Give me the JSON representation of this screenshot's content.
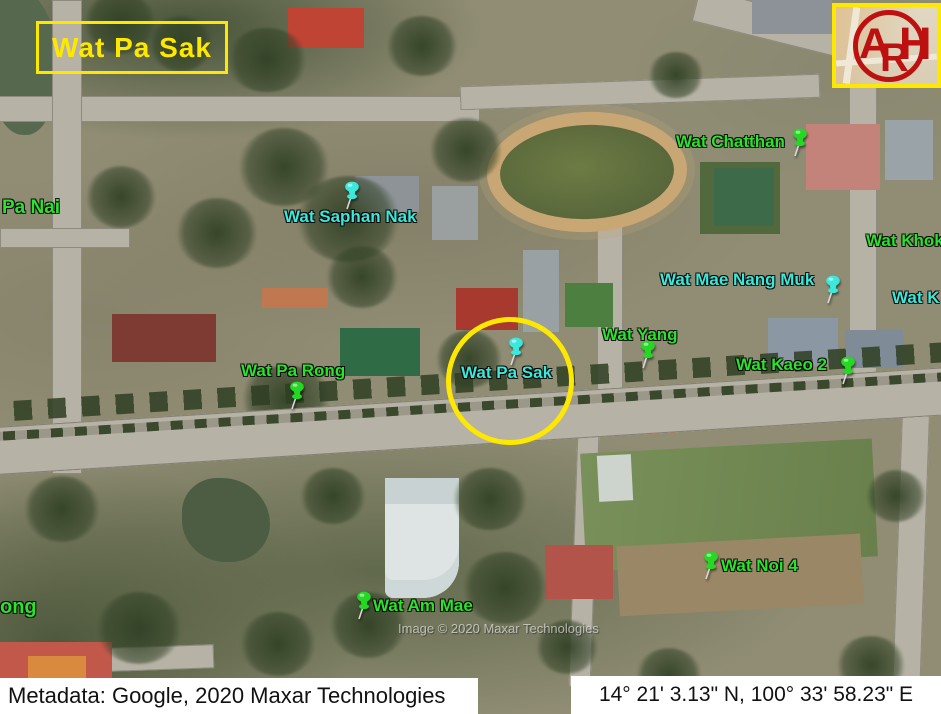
{
  "title_box": {
    "label": "Wat Pa Sak"
  },
  "logo": {
    "letters": [
      "A",
      "R",
      "H"
    ]
  },
  "map": {
    "markers": [
      {
        "id": "pa-nai",
        "label": "Pa Nai",
        "color": "green",
        "pin": false
      },
      {
        "id": "wat-saphan-nak",
        "label": "Wat Saphan Nak",
        "color": "cyan",
        "pin": true
      },
      {
        "id": "wat-chatthan",
        "label": "Wat Chatthan",
        "color": "green",
        "pin": true
      },
      {
        "id": "wat-khok",
        "label": "Wat Khok",
        "color": "green",
        "pin": false
      },
      {
        "id": "wat-mae-nang-muk",
        "label": "Wat Mae Nang Muk",
        "color": "cyan",
        "pin": true
      },
      {
        "id": "wat-k",
        "label": "Wat K",
        "color": "cyan",
        "pin": false
      },
      {
        "id": "wat-yang",
        "label": "Wat Yang",
        "color": "green",
        "pin": true
      },
      {
        "id": "wat-kaeo-2",
        "label": "Wat Kaeo 2",
        "color": "green",
        "pin": true
      },
      {
        "id": "wat-pa-rong",
        "label": "Wat Pa Rong",
        "color": "green",
        "pin": true
      },
      {
        "id": "wat-pa-sak",
        "label": "Wat Pa Sak",
        "color": "cyan",
        "pin": true,
        "highlighted": true
      },
      {
        "id": "wat-noi-4",
        "label": "Wat Noi 4",
        "color": "green",
        "pin": true
      },
      {
        "id": "wat-am-mae",
        "label": "Wat Am Mae",
        "color": "green",
        "pin": true
      },
      {
        "id": "ong",
        "label": "ong",
        "color": "green",
        "pin": false
      }
    ],
    "watermark": "Image © 2020 Maxar Technologies"
  },
  "footer": {
    "metadata": "Metadata: Google, 2020 Maxar Technologies",
    "coordinates": "14° 21' 3.13\" N, 100° 33' 58.23\" E"
  },
  "colors": {
    "label_green": "#2BE32B",
    "label_cyan": "#3CE8DC",
    "highlight_yellow": "#FFE800",
    "logo_red": "#BD1010"
  }
}
